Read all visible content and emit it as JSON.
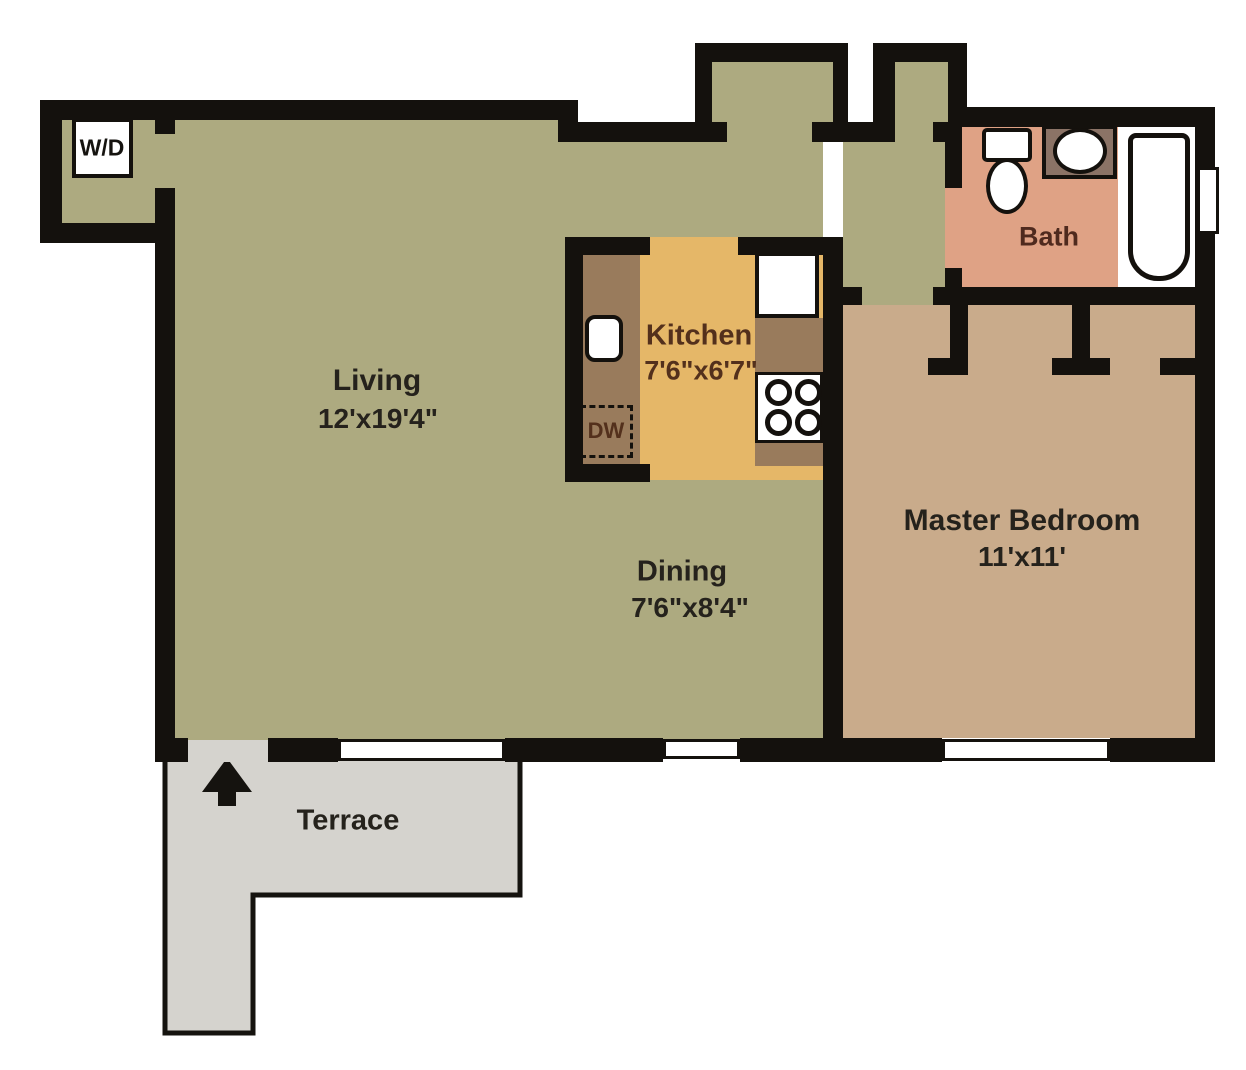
{
  "floorplan": {
    "rooms": {
      "living": {
        "label": "Living",
        "dimensions": "12'x19'4\""
      },
      "kitchen": {
        "label": "Kitchen",
        "dimensions": "7'6\"x6'7\""
      },
      "dining": {
        "label": "Dining",
        "dimensions": "7'6\"x8'4\""
      },
      "master_bedroom": {
        "label": "Master Bedroom",
        "dimensions": "11'x11'"
      },
      "bath": {
        "label": "Bath"
      },
      "terrace": {
        "label": "Terrace"
      }
    },
    "labels": {
      "washer_dryer": "W/D",
      "dishwasher": "DW"
    },
    "colors": {
      "wall": "#14110d",
      "living_floor": "#adaa80",
      "kitchen_floor": "#e5b768",
      "counter": "#997b5c",
      "vanity": "#8b7366",
      "bath_floor": "#dfa285",
      "bedroom_floor": "#c9ab8b",
      "terrace_floor": "#d5d3ce",
      "fixture_white": "#ffffff",
      "label_text": "#25221c",
      "kitchen_text": "#53301c",
      "bath_text": "#4f2a1e"
    }
  }
}
